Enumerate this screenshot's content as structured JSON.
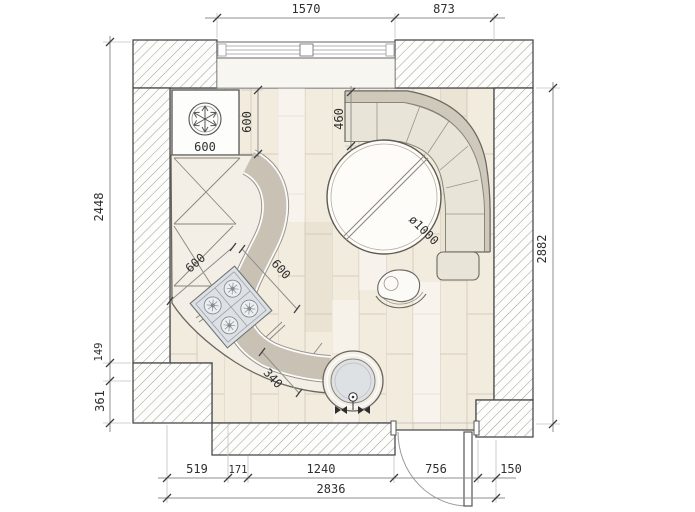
{
  "plan": {
    "title": "kitchen floor plan with curved counter, corner bench and round table",
    "dims": {
      "top_window": "1570",
      "top_wall": "873",
      "left_wall": "2448",
      "left_step": "149",
      "left_lower": "361",
      "right_room": "2882",
      "bottom_1": "519",
      "bottom_2": "171",
      "bottom_3": "1240",
      "bottom_door": "756",
      "bottom_5": "150",
      "bottom_total": "2836",
      "fridge_width": "600",
      "fridge_depth": "600",
      "bench_seat": "460",
      "table_dia": "ø1000",
      "hob_a": "600",
      "hob_b": "600",
      "sink_unit": "340"
    },
    "colors": {
      "wall_line": "#4a4a4a",
      "hatch": "#9c9c9c",
      "floor": "#f2ecdf",
      "floor_line": "#d7cebc",
      "counter_light": "#f3efe6",
      "counter_band": "#c8c1b4",
      "bench_seat": "#e9e4d8",
      "bench_back": "#cfc9bc",
      "hob_fill": "#dde1e5",
      "sink_fill": "#dde1e4",
      "dim_line": "#8f8f8f",
      "dim_text": "#2f2f2f"
    },
    "icons": [
      "snowflake-icon",
      "burner-icon",
      "valve-icon",
      "door-swing-icon",
      "window-icon"
    ]
  }
}
